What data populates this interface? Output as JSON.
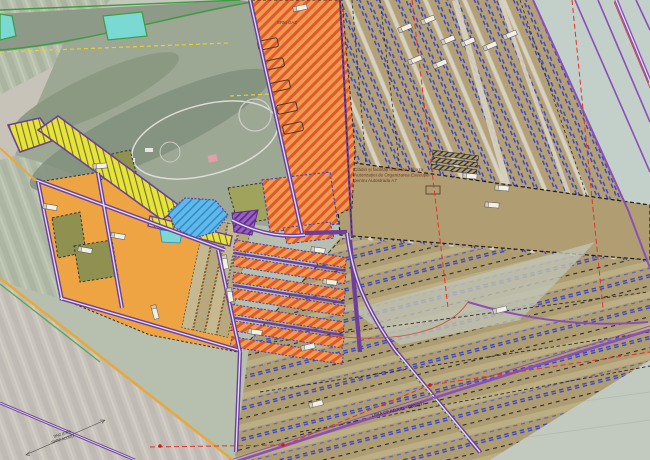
{
  "map": {
    "labels": {
      "facility_note_line1": "Clădiri și facilități realizate în baza",
      "facility_note_line2": "Autorizației de Organizarea Execuției",
      "facility_note_line3": "pentru Autostrada A7",
      "gas_station": "SRM GAZ",
      "railway": "LINIA CF ADJUD - ONEȘTI",
      "road_line1": "DN2 (E85)",
      "road_line2": "SPRE ADJUD"
    },
    "palette": {
      "orange_hatch_base": "#F29A50",
      "orange_hatch_stripe": "#DE5A2C",
      "orange_solid": "#EFA443",
      "yellow_base": "#E6E23E",
      "yellow_stripe": "#71711F",
      "khaki_corridor": "#B3A076",
      "blue_zone": "#5FB9E8",
      "purple_zone": "#9A5FC0",
      "olive_parcel": "#8F9150",
      "road_purple": "#6C3E9E",
      "dash_blue": "#3A45C5",
      "dash_red": "#E03228",
      "railway_purple": "#8A4FB8",
      "boundary_amber": "#E9A83C",
      "line_green": "#3E9C40",
      "dash_yellow": "#E8D22A",
      "pond_cyan": "#7BD9D4",
      "satellite_green": "#A9B3A1",
      "satellite_pale": "#C6CCC0"
    },
    "zones": [
      {
        "name": "orange-hatched-construction-band",
        "fill": "#F29A50"
      },
      {
        "name": "solid-orange-parcels",
        "fill": "#EFA443"
      },
      {
        "name": "yellow-hatched-strip",
        "fill": "#E6E23E"
      },
      {
        "name": "khaki-motorway-corridor-strips",
        "fill": "#B3A076"
      },
      {
        "name": "khaki-facility-site-dashed",
        "fill": "#B09E72"
      },
      {
        "name": "blue-hatched-zone",
        "fill": "#5FB9E8"
      },
      {
        "name": "purple-hatched-zone",
        "fill": "#9A5FC0"
      },
      {
        "name": "olive-parcels",
        "fill": "#8F9150"
      },
      {
        "name": "satellite-fields",
        "fill": "#C6CCC0"
      }
    ],
    "icons": {
      "truck_icon": "plan-view truck/vehicle marker",
      "building_outline_icon": "building footprint outline",
      "red_vertex_dot": "red boundary vertex marker",
      "pond_icon": "water basin"
    }
  }
}
